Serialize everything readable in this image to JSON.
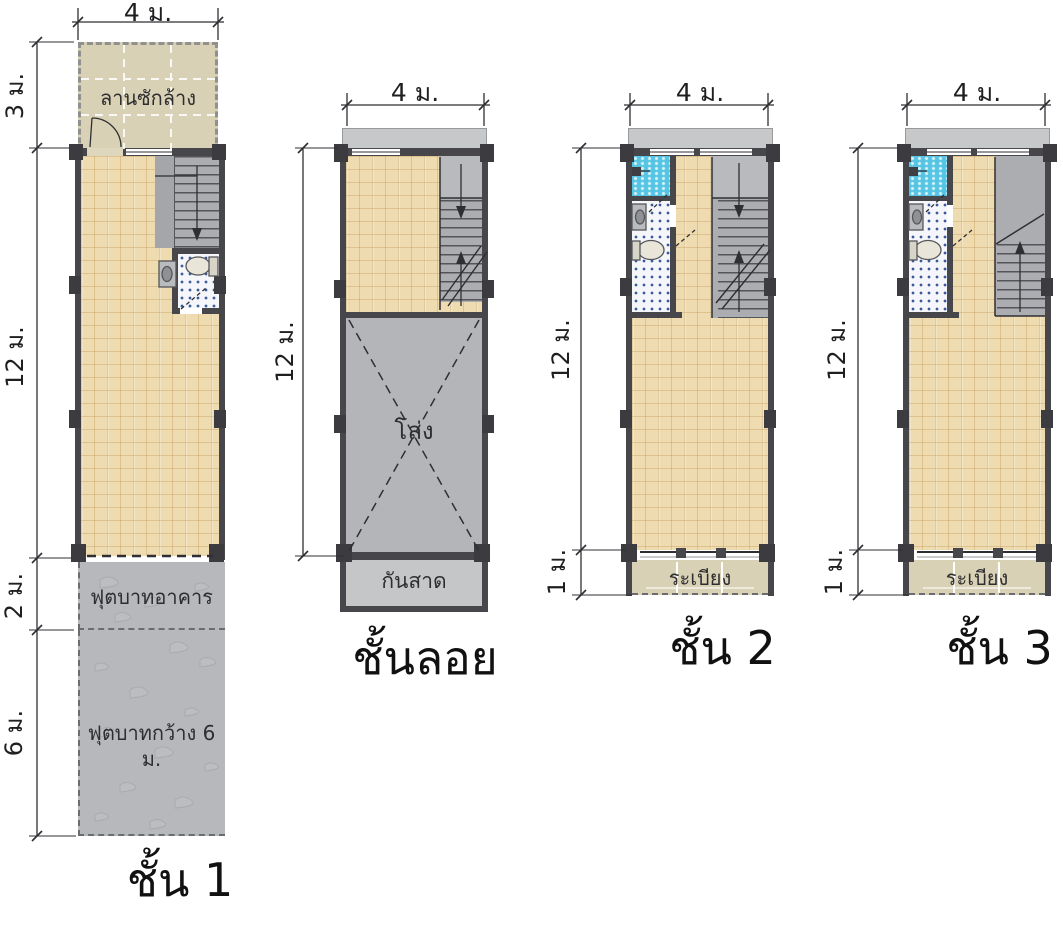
{
  "sheet": {
    "type": "architectural-floor-plans",
    "unit_note": "ม. = meters"
  },
  "colors": {
    "wall": "#47474b",
    "column_post": "#3c3c40",
    "floor_tile": "#eedbb0",
    "stair": "#abadb0",
    "concrete_walkway": "#b6b8bb",
    "laundry_balcony": "#d9d1b5",
    "shower": "#56c5e4",
    "bath_tile_dots": "#39589e",
    "awning": "#c7c8ca",
    "linework": "#2f2f33"
  },
  "plans": [
    {
      "title": "ชั้น 1",
      "dims": {
        "top": "4 ม.",
        "laundry": "3 ม.",
        "building": "12 ม.",
        "walkway_near": "2 ม.",
        "walkway_far": "6 ม."
      },
      "labels": {
        "laundry": "ลานซักล้าง",
        "walkway_near": "ฟุตบาทอาคาร",
        "walkway_far": "ฟุตบาทกว้าง 6 ม."
      }
    },
    {
      "title": "ชั้นลอย",
      "dims": {
        "top": "4 ม.",
        "building": "12 ม."
      },
      "labels": {
        "void": "โล่ง",
        "awning": "กันสาด"
      }
    },
    {
      "title": "ชั้น 2",
      "dims": {
        "top": "4 ม.",
        "building": "12 ม.",
        "balcony": "1 ม."
      },
      "labels": {
        "balcony": "ระเบียง"
      }
    },
    {
      "title": "ชั้น 3",
      "dims": {
        "top": "4 ม.",
        "building": "12 ม.",
        "balcony": "1 ม."
      },
      "labels": {
        "balcony": "ระเบียง"
      }
    }
  ]
}
